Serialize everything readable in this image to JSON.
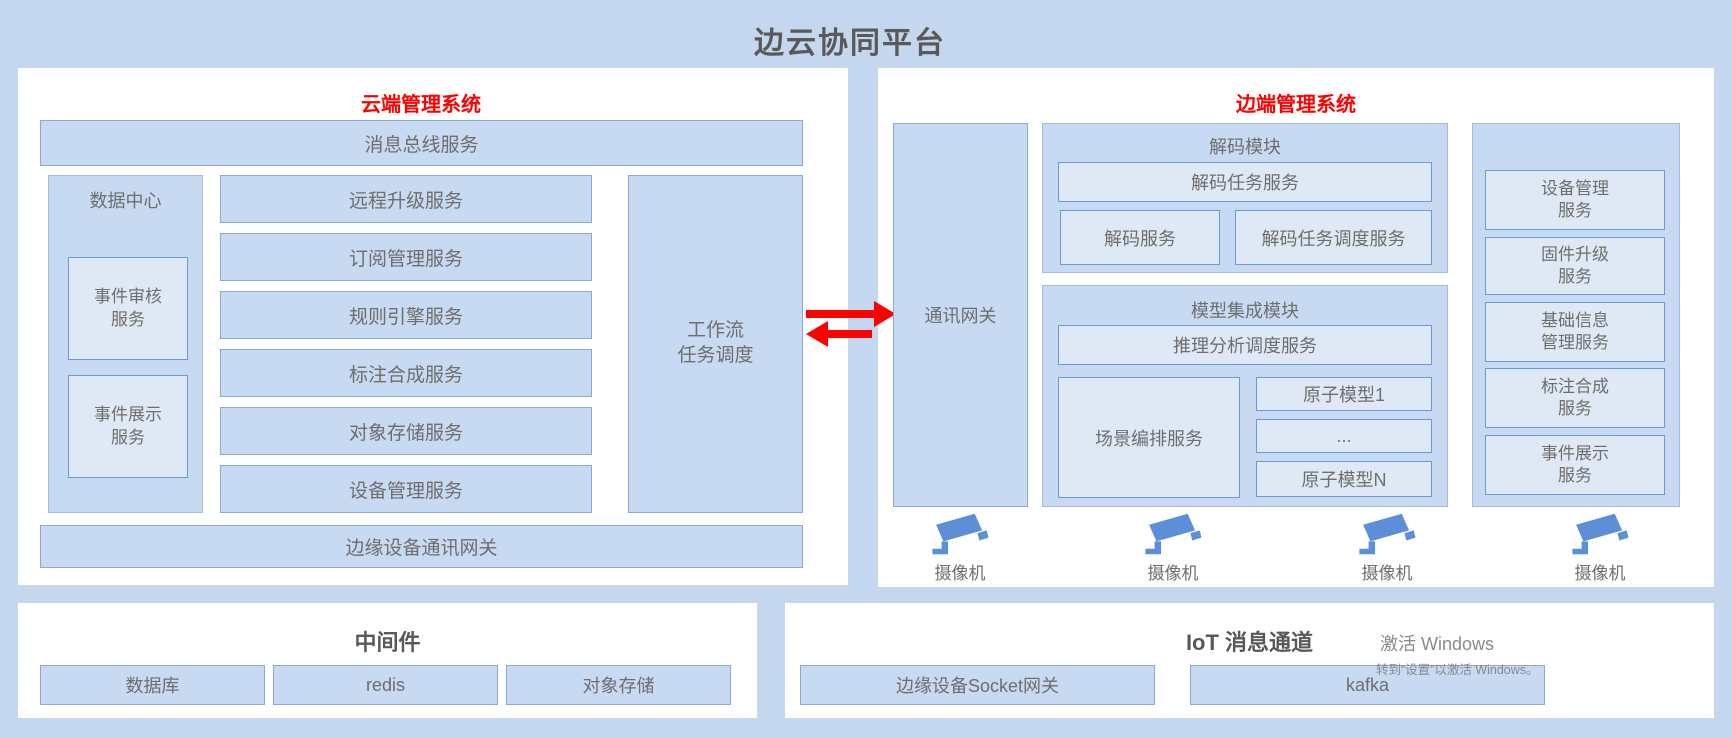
{
  "page_title": "边云协同平台",
  "colors": {
    "background": "#c4d7ee",
    "panel": "#ffffff",
    "box_fill": "#c7daf1",
    "box_border": "#8aa8da",
    "inner_fill": "#dfe9f5",
    "inner_border": "#6b9bd7",
    "accent_red": "#ff0000",
    "camera_blue": "#5d8fd8",
    "text_gray": "#6e6e6e",
    "title_gray": "#595959"
  },
  "cloud_panel": {
    "title": "云端管理系统",
    "message_bus": "消息总线服务",
    "data_center": {
      "title": "数据中心",
      "items": [
        "事件审核\n服务",
        "事件展示\n服务"
      ]
    },
    "services": [
      "远程升级服务",
      "订阅管理服务",
      "规则引擎服务",
      "标注合成服务",
      "对象存储服务",
      "设备管理服务"
    ],
    "workflow": "工作流\n任务调度",
    "edge_gateway_bar": "边缘设备通讯网关"
  },
  "edge_panel": {
    "title": "边端管理系统",
    "comm_gateway": "通讯网关",
    "decode_module": {
      "title": "解码模块",
      "task_service": "解码任务服务",
      "decode_service": "解码服务",
      "task_scheduler_service": "解码任务调度服务"
    },
    "model_module": {
      "title": "模型集成模块",
      "inference_scheduler": "推理分析调度服务",
      "scene_orchestration": "场景编排服务",
      "atomic_models": [
        "原子模型1",
        "...",
        "原子模型N"
      ]
    },
    "device_services": [
      "设备管理\n服务",
      "固件升级\n服务",
      "基础信息\n管理服务",
      "标注合成\n服务",
      "事件展示\n服务"
    ],
    "camera_label": "摄像机"
  },
  "middleware_panel": {
    "title": "中间件",
    "items": [
      "数据库",
      "redis",
      "对象存储"
    ]
  },
  "iot_panel": {
    "title": "IoT 消息通道",
    "items": [
      "边缘设备Socket网关",
      "kafka"
    ]
  },
  "watermark": {
    "line1": "激活 Windows",
    "line2": "转到“设置”以激活 Windows。"
  }
}
